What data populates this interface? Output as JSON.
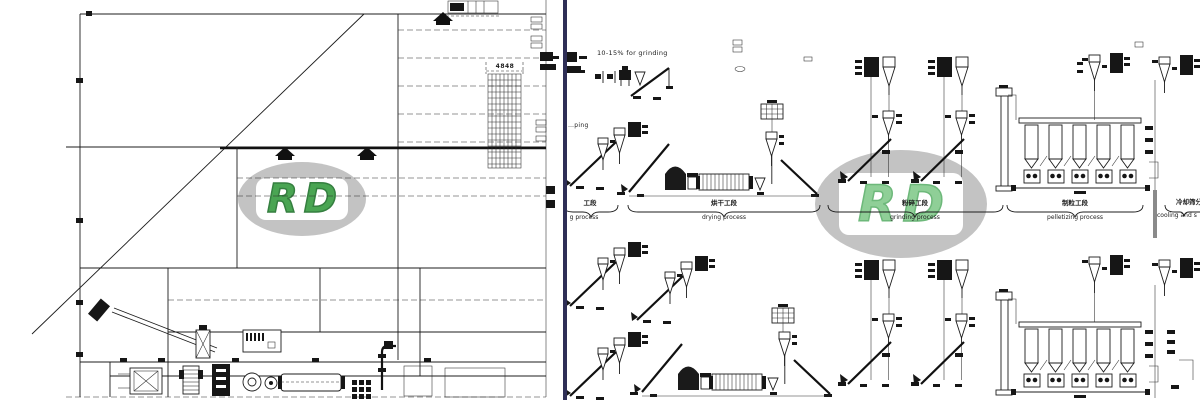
{
  "colors": {
    "divider_navy": "#2e2e56",
    "line_black": "#1c1c1c",
    "watermark_gray": "#c3c3c3",
    "watermark_green_left": "#4aa553",
    "watermark_green_right": "#8fcf97"
  },
  "left_drawing": {
    "description": "factory floor plan with diagonal wall, hatched panel area and pellet line equipment row",
    "dimension_label": "4848",
    "watermark": {
      "letter_r": "R",
      "letter_d": "D"
    }
  },
  "right_drawing": {
    "description": "two-line feed pellet process flow diagram",
    "annotation_grinding_share": "10-15% for grinding",
    "edge_label_fragment": "…ping",
    "watermark": {
      "letter_r": "R",
      "letter_d": "D"
    },
    "sections": [
      {
        "cn": "工段",
        "en": "g process"
      },
      {
        "cn": "烘干工段",
        "en": "drying process"
      },
      {
        "cn": "粉碎工段",
        "en": "grinding process"
      },
      {
        "cn": "制粒工段",
        "en": "pelletizing process"
      },
      {
        "cn": "冷却筛分",
        "en": "cooling and s"
      }
    ]
  }
}
